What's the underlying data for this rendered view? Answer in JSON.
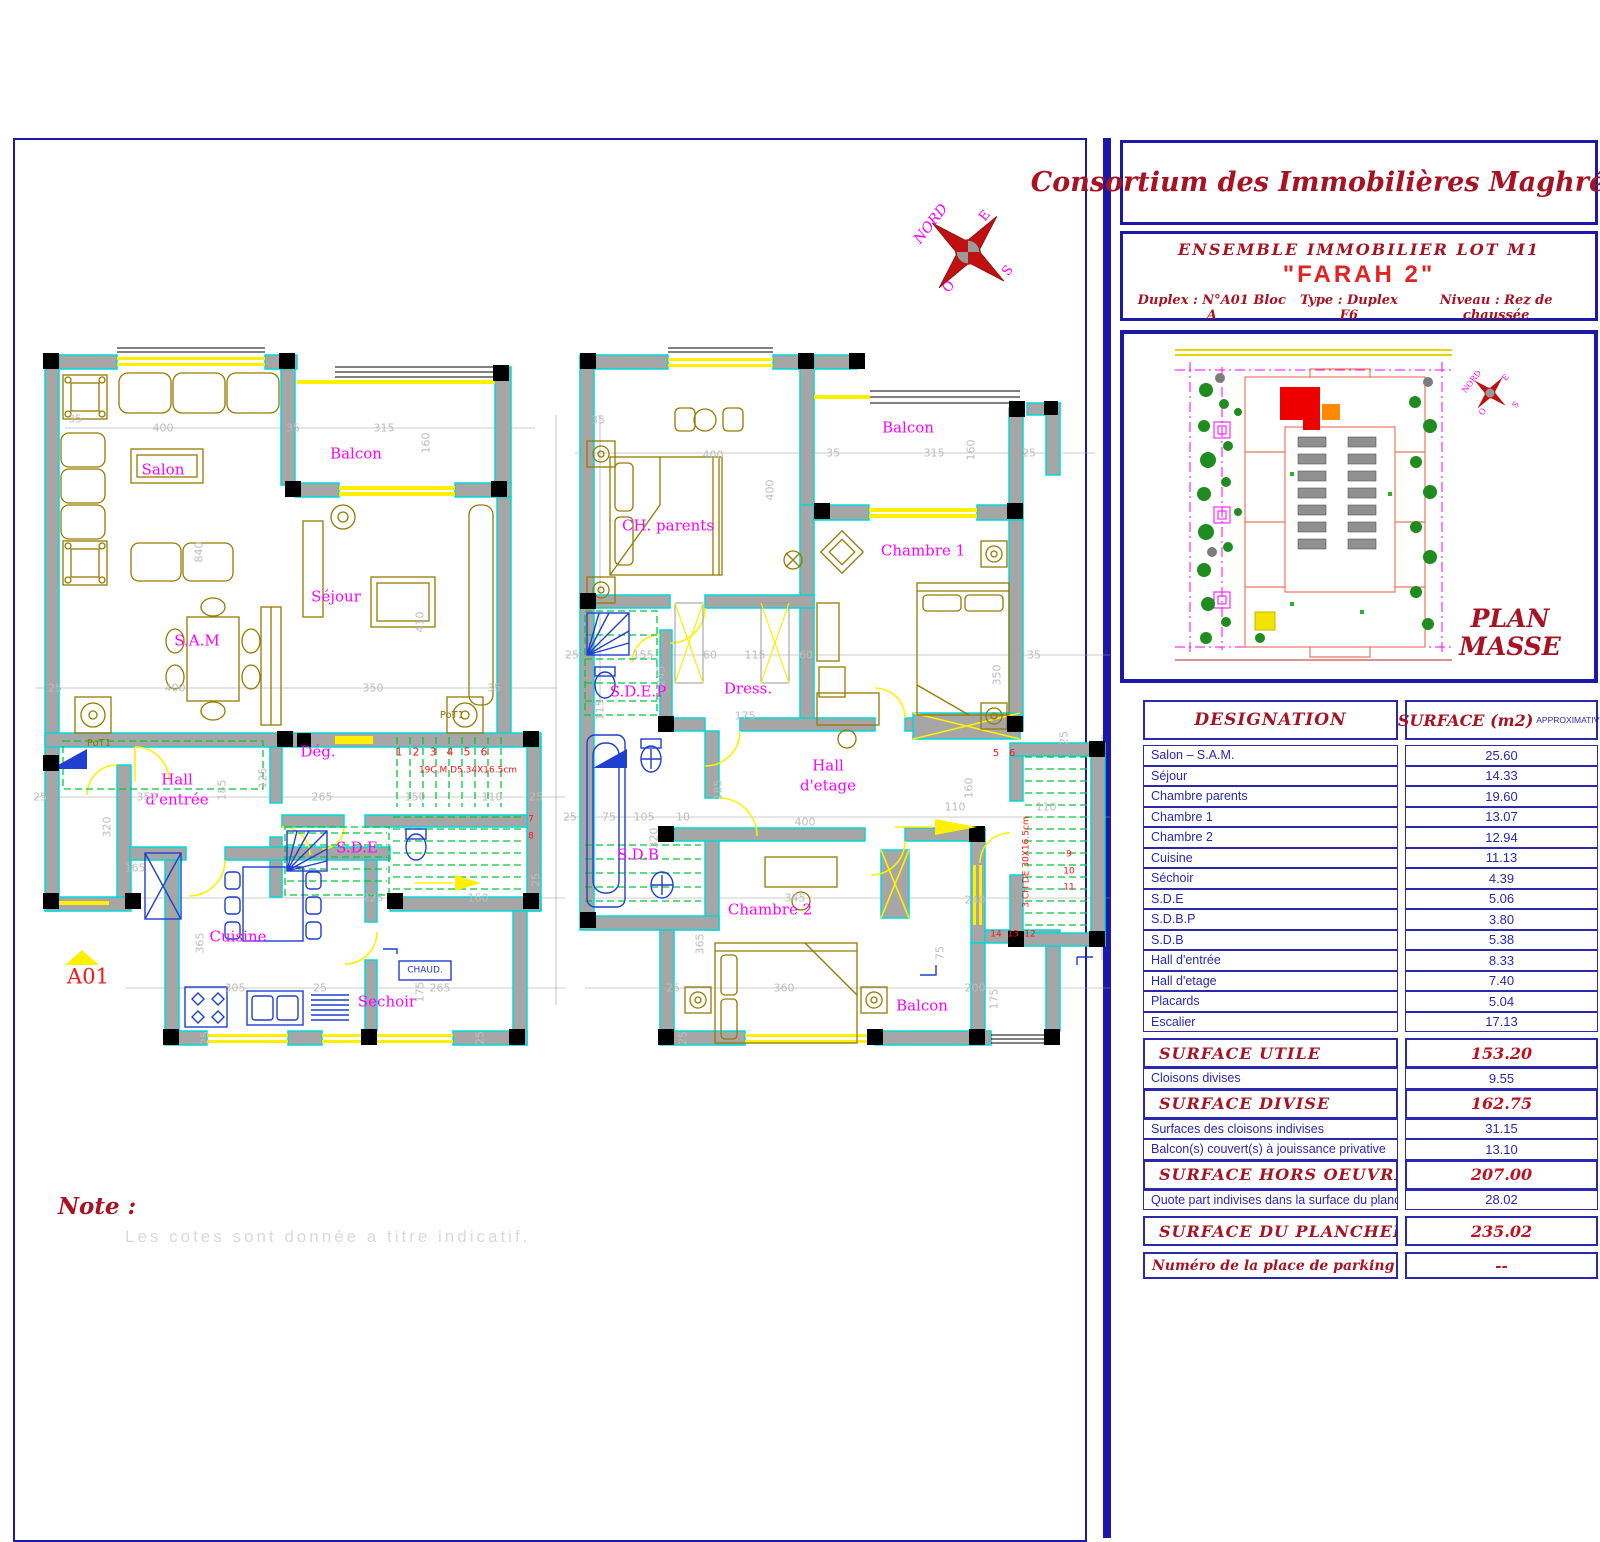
{
  "palette": {
    "mag": "#FF00FF",
    "red": "#FF1414",
    "dim": "#BDBDBD",
    "olive": "#8F7600",
    "blue": "#2233CC",
    "drk": "#A81324",
    "ltg": "#D9D9D9"
  },
  "title_block": {
    "company": "Consortium des Immobilières Maghrébines",
    "project": "ENSEMBLE   IMMOBILIER   LOT   M1",
    "name": "\"FARAH 2\"",
    "duplex": "Duplex : N°A01  Bloc A",
    "type": "Type : Duplex F6",
    "niveau": "Niveau : Rez de chaussée"
  },
  "plan_masse": {
    "caption1": "PLAN",
    "caption2": "MASSE"
  },
  "compass": {
    "north": "NORD",
    "east": "E",
    "west": "O",
    "south": "S"
  },
  "note": {
    "heading": "Note :",
    "text": "Les cotes sont donnée a titre indicatif."
  },
  "surface_table": {
    "header": {
      "designation": "DESIGNATION",
      "surface": "SURFACE  (m2)",
      "approx": "APPROXIMATIVE"
    },
    "rows": [
      {
        "label": "Salon – S.A.M.",
        "value": "25.60",
        "style": "item"
      },
      {
        "label": "Séjour",
        "value": "14.33",
        "style": "item"
      },
      {
        "label": "Chambre  parents",
        "value": "19.60",
        "style": "item"
      },
      {
        "label": "Chambre  1",
        "value": "13.07",
        "style": "item"
      },
      {
        "label": "Chambre  2",
        "value": "12.94",
        "style": "item"
      },
      {
        "label": "Cuisine",
        "value": "11.13",
        "style": "item"
      },
      {
        "label": "Séchoir",
        "value": "4.39",
        "style": "item"
      },
      {
        "label": "S.D.E",
        "value": "5.06",
        "style": "item"
      },
      {
        "label": "S.D.B.P",
        "value": "3.80",
        "style": "item"
      },
      {
        "label": "S.D.B",
        "value": "5.38",
        "style": "item"
      },
      {
        "label": "Hall  d'entrée",
        "value": "8.33",
        "style": "item"
      },
      {
        "label": "Hall  d'etage",
        "value": "7.40",
        "style": "item"
      },
      {
        "label": "Placards",
        "value": "5.04",
        "style": "item"
      },
      {
        "label": "Escalier",
        "value": "17.13",
        "style": "item"
      },
      {
        "label": "SURFACE  UTILE",
        "value": "153.20",
        "style": "total",
        "gap": true
      },
      {
        "label": "Cloisons  divises",
        "value": "9.55",
        "style": "item"
      },
      {
        "label": "SURFACE  DIVISE",
        "value": "162.75",
        "style": "total"
      },
      {
        "label": "Surfaces  des  cloisons  indivises",
        "value": "31.15",
        "style": "item"
      },
      {
        "label": "Balcon(s)  couvert(s)  à  jouissance  privative",
        "value": "13.10",
        "style": "item"
      },
      {
        "label": "SURFACE  HORS  OEUVRE",
        "value": "207.00",
        "style": "total"
      },
      {
        "label": "Quote  part  indivises  dans  la  surface  du  plancher",
        "value": "28.02",
        "style": "item"
      },
      {
        "label": "SURFACE  DU  PLANCHER",
        "value": "235.02",
        "style": "total",
        "gap": true
      },
      {
        "label": "Numéro  de  la  place  de  parking",
        "value": "--",
        "style": "footer",
        "gap": true
      }
    ]
  },
  "plan_labels": [
    {
      "t": "Salon",
      "x": 163,
      "y": 470,
      "s": 15,
      "c": "mag"
    },
    {
      "t": "Balcon",
      "x": 356,
      "y": 454,
      "s": 15,
      "c": "mag"
    },
    {
      "t": "Séjour",
      "x": 336,
      "y": 597,
      "s": 15,
      "c": "mag"
    },
    {
      "t": "S.A.M",
      "x": 197,
      "y": 641,
      "s": 15,
      "c": "mag"
    },
    {
      "t": "Dég.",
      "x": 318,
      "y": 752,
      "s": 15,
      "c": "mag"
    },
    {
      "t": "Hall",
      "x": 177,
      "y": 780,
      "s": 15,
      "c": "mag"
    },
    {
      "t": "d'entrée",
      "x": 177,
      "y": 800,
      "s": 15,
      "c": "mag"
    },
    {
      "t": "S.D.E",
      "x": 357,
      "y": 848,
      "s": 15,
      "c": "mag"
    },
    {
      "t": "Cuisine",
      "x": 238,
      "y": 937,
      "s": 15,
      "c": "mag"
    },
    {
      "t": "Sechoir",
      "x": 387,
      "y": 1002,
      "s": 15,
      "c": "mag"
    },
    {
      "t": "A01",
      "x": 88,
      "y": 977,
      "s": 21,
      "c": "red",
      "f": "serif"
    },
    {
      "t": "PoT1",
      "x": 99,
      "y": 744,
      "s": 10,
      "c": "olive"
    },
    {
      "t": "PoT1",
      "x": 452,
      "y": 716,
      "s": 10,
      "c": "olive"
    },
    {
      "t": "1",
      "x": 399,
      "y": 752,
      "s": 11,
      "c": "red"
    },
    {
      "t": "2",
      "x": 416,
      "y": 752,
      "s": 11,
      "c": "red"
    },
    {
      "t": "3",
      "x": 433,
      "y": 752,
      "s": 11,
      "c": "red"
    },
    {
      "t": "4",
      "x": 450,
      "y": 752,
      "s": 11,
      "c": "red"
    },
    {
      "t": "5",
      "x": 467,
      "y": 752,
      "s": 11,
      "c": "red"
    },
    {
      "t": "6",
      "x": 484,
      "y": 752,
      "s": 11,
      "c": "red"
    },
    {
      "t": "19C.M D5.34X16.5cm",
      "x": 468,
      "y": 771,
      "s": 9,
      "c": "red"
    },
    {
      "t": "7",
      "x": 531,
      "y": 820,
      "s": 9,
      "c": "red"
    },
    {
      "t": "8",
      "x": 531,
      "y": 837,
      "s": 9,
      "c": "red"
    },
    {
      "t": "CHAUD.",
      "x": 425,
      "y": 971,
      "s": 9,
      "c": "blue"
    },
    {
      "t": "35",
      "x": 75,
      "y": 419,
      "s": 11,
      "c": "dim"
    },
    {
      "t": "400",
      "x": 163,
      "y": 428,
      "s": 11,
      "c": "dim"
    },
    {
      "t": "35",
      "x": 293,
      "y": 428,
      "s": 11,
      "c": "dim"
    },
    {
      "t": "315",
      "x": 384,
      "y": 428,
      "s": 11,
      "c": "dim"
    },
    {
      "t": "160",
      "x": 426,
      "y": 443,
      "s": 11,
      "c": "dim",
      "r": -90
    },
    {
      "t": "840",
      "x": 199,
      "y": 552,
      "s": 11,
      "c": "dim",
      "r": -90
    },
    {
      "t": "410",
      "x": 420,
      "y": 622,
      "s": 11,
      "c": "dim",
      "r": -90
    },
    {
      "t": "25",
      "x": 55,
      "y": 688,
      "s": 11,
      "c": "dim"
    },
    {
      "t": "400",
      "x": 175,
      "y": 688,
      "s": 11,
      "c": "dim"
    },
    {
      "t": "350",
      "x": 373,
      "y": 688,
      "s": 11,
      "c": "dim"
    },
    {
      "t": "35",
      "x": 494,
      "y": 688,
      "s": 11,
      "c": "dim"
    },
    {
      "t": "25",
      "x": 40,
      "y": 797,
      "s": 11,
      "c": "dim"
    },
    {
      "t": "350",
      "x": 147,
      "y": 797,
      "s": 11,
      "c": "dim"
    },
    {
      "t": "185",
      "x": 222,
      "y": 790,
      "s": 11,
      "c": "dim",
      "r": -90
    },
    {
      "t": "265",
      "x": 322,
      "y": 797,
      "s": 11,
      "c": "dim"
    },
    {
      "t": "125",
      "x": 263,
      "y": 778,
      "s": 11,
      "c": "dim",
      "r": -90
    },
    {
      "t": "150",
      "x": 415,
      "y": 797,
      "s": 11,
      "c": "dim"
    },
    {
      "t": "110",
      "x": 492,
      "y": 797,
      "s": 11,
      "c": "dim"
    },
    {
      "t": "25",
      "x": 536,
      "y": 797,
      "s": 11,
      "c": "dim"
    },
    {
      "t": "320",
      "x": 107,
      "y": 827,
      "s": 11,
      "c": "dim",
      "r": -90
    },
    {
      "t": "165",
      "x": 135,
      "y": 868,
      "s": 11,
      "c": "dim"
    },
    {
      "t": "225",
      "x": 373,
      "y": 898,
      "s": 11,
      "c": "dim"
    },
    {
      "t": "160",
      "x": 478,
      "y": 898,
      "s": 11,
      "c": "dim"
    },
    {
      "t": "25",
      "x": 536,
      "y": 880,
      "s": 11,
      "c": "dim",
      "r": -90
    },
    {
      "t": "365",
      "x": 200,
      "y": 943,
      "s": 11,
      "c": "dim",
      "r": -90
    },
    {
      "t": "305",
      "x": 235,
      "y": 988,
      "s": 11,
      "c": "dim"
    },
    {
      "t": "25",
      "x": 320,
      "y": 988,
      "s": 11,
      "c": "dim"
    },
    {
      "t": "265",
      "x": 440,
      "y": 988,
      "s": 11,
      "c": "dim"
    },
    {
      "t": "175",
      "x": 420,
      "y": 992,
      "s": 11,
      "c": "dim",
      "r": -90
    },
    {
      "t": "25",
      "x": 205,
      "y": 1038,
      "s": 11,
      "c": "dim",
      "r": -90
    },
    {
      "t": "25",
      "x": 480,
      "y": 1038,
      "s": 11,
      "c": "dim",
      "r": -90
    },
    {
      "t": "CH. parents",
      "x": 668,
      "y": 526,
      "s": 15,
      "c": "mag"
    },
    {
      "t": "Balcon",
      "x": 908,
      "y": 428,
      "s": 15,
      "c": "mag"
    },
    {
      "t": "Chambre 1",
      "x": 923,
      "y": 551,
      "s": 15,
      "c": "mag"
    },
    {
      "t": "S.D.E.P",
      "x": 638,
      "y": 692,
      "s": 15,
      "c": "mag"
    },
    {
      "t": "Dress.",
      "x": 748,
      "y": 689,
      "s": 15,
      "c": "mag"
    },
    {
      "t": "Hall",
      "x": 828,
      "y": 766,
      "s": 15,
      "c": "mag"
    },
    {
      "t": "d'etage",
      "x": 828,
      "y": 786,
      "s": 15,
      "c": "mag"
    },
    {
      "t": "S.D.B",
      "x": 638,
      "y": 855,
      "s": 15,
      "c": "mag"
    },
    {
      "t": "Chambre 2",
      "x": 770,
      "y": 910,
      "s": 15,
      "c": "mag"
    },
    {
      "t": "Balcon",
      "x": 922,
      "y": 1006,
      "s": 15,
      "c": "mag"
    },
    {
      "t": "5",
      "x": 996,
      "y": 754,
      "s": 10,
      "c": "red"
    },
    {
      "t": "6",
      "x": 1012,
      "y": 754,
      "s": 10,
      "c": "red"
    },
    {
      "t": "3 CH DE 30X16.5cm",
      "x": 1027,
      "y": 862,
      "s": 9,
      "c": "red",
      "r": -90
    },
    {
      "t": "9",
      "x": 1069,
      "y": 855,
      "s": 9,
      "c": "red"
    },
    {
      "t": "10",
      "x": 1069,
      "y": 872,
      "s": 9,
      "c": "red"
    },
    {
      "t": "11",
      "x": 1069,
      "y": 888,
      "s": 9,
      "c": "red"
    },
    {
      "t": "14",
      "x": 996,
      "y": 935,
      "s": 9,
      "c": "red"
    },
    {
      "t": "13",
      "x": 1013,
      "y": 935,
      "s": 9,
      "c": "red"
    },
    {
      "t": "12",
      "x": 1030,
      "y": 935,
      "s": 9,
      "c": "red"
    },
    {
      "t": "35",
      "x": 598,
      "y": 420,
      "s": 11,
      "c": "dim"
    },
    {
      "t": "400",
      "x": 713,
      "y": 455,
      "s": 11,
      "c": "dim"
    },
    {
      "t": "35",
      "x": 833,
      "y": 453,
      "s": 11,
      "c": "dim"
    },
    {
      "t": "315",
      "x": 934,
      "y": 453,
      "s": 11,
      "c": "dim"
    },
    {
      "t": "160",
      "x": 971,
      "y": 450,
      "s": 11,
      "c": "dim",
      "r": -90
    },
    {
      "t": "25",
      "x": 1029,
      "y": 453,
      "s": 11,
      "c": "dim"
    },
    {
      "t": "400",
      "x": 770,
      "y": 490,
      "s": 11,
      "c": "dim",
      "r": -90
    },
    {
      "t": "350",
      "x": 997,
      "y": 675,
      "s": 11,
      "c": "dim",
      "r": -90
    },
    {
      "t": "25",
      "x": 572,
      "y": 655,
      "s": 11,
      "c": "dim"
    },
    {
      "t": "155",
      "x": 643,
      "y": 655,
      "s": 11,
      "c": "dim"
    },
    {
      "t": "245",
      "x": 661,
      "y": 676,
      "s": 11,
      "c": "dim",
      "r": -90
    },
    {
      "t": "60",
      "x": 710,
      "y": 655,
      "s": 11,
      "c": "dim"
    },
    {
      "t": "115",
      "x": 755,
      "y": 655,
      "s": 11,
      "c": "dim"
    },
    {
      "t": "60",
      "x": 806,
      "y": 655,
      "s": 11,
      "c": "dim"
    },
    {
      "t": "35",
      "x": 1034,
      "y": 655,
      "s": 11,
      "c": "dim"
    },
    {
      "t": "115",
      "x": 600,
      "y": 710,
      "s": 11,
      "c": "dim",
      "r": -90
    },
    {
      "t": "175",
      "x": 745,
      "y": 716,
      "s": 11,
      "c": "dim"
    },
    {
      "t": "185",
      "x": 718,
      "y": 790,
      "s": 11,
      "c": "dim",
      "r": -90
    },
    {
      "t": "25",
      "x": 570,
      "y": 817,
      "s": 11,
      "c": "dim"
    },
    {
      "t": "75",
      "x": 609,
      "y": 817,
      "s": 11,
      "c": "dim"
    },
    {
      "t": "105",
      "x": 644,
      "y": 817,
      "s": 11,
      "c": "dim"
    },
    {
      "t": "10",
      "x": 683,
      "y": 817,
      "s": 11,
      "c": "dim"
    },
    {
      "t": "400",
      "x": 805,
      "y": 822,
      "s": 11,
      "c": "dim"
    },
    {
      "t": "320",
      "x": 654,
      "y": 838,
      "s": 11,
      "c": "dim",
      "r": -90
    },
    {
      "t": "110",
      "x": 955,
      "y": 807,
      "s": 11,
      "c": "dim"
    },
    {
      "t": "160",
      "x": 969,
      "y": 788,
      "s": 11,
      "c": "dim",
      "r": -90
    },
    {
      "t": "110",
      "x": 1046,
      "y": 807,
      "s": 11,
      "c": "dim"
    },
    {
      "t": "25",
      "x": 1064,
      "y": 738,
      "s": 11,
      "c": "dim",
      "r": -90
    },
    {
      "t": "345",
      "x": 795,
      "y": 898,
      "s": 11,
      "c": "dim"
    },
    {
      "t": "240",
      "x": 975,
      "y": 900,
      "s": 11,
      "c": "dim"
    },
    {
      "t": "365",
      "x": 700,
      "y": 944,
      "s": 11,
      "c": "dim",
      "r": -90
    },
    {
      "t": "360",
      "x": 784,
      "y": 988,
      "s": 11,
      "c": "dim"
    },
    {
      "t": "25",
      "x": 673,
      "y": 988,
      "s": 11,
      "c": "dim"
    },
    {
      "t": "200",
      "x": 975,
      "y": 988,
      "s": 11,
      "c": "dim"
    },
    {
      "t": "175",
      "x": 994,
      "y": 999,
      "s": 11,
      "c": "dim",
      "r": -90
    },
    {
      "t": "25",
      "x": 683,
      "y": 1038,
      "s": 11,
      "c": "dim",
      "r": -90
    },
    {
      "t": "75",
      "x": 940,
      "y": 953,
      "s": 11,
      "c": "dim",
      "r": -90
    },
    {
      "t": "NORD",
      "x": 931,
      "y": 224,
      "s": 14,
      "c": "mag",
      "r": -52,
      "f": "serif",
      "i": true
    },
    {
      "t": "E",
      "x": 985,
      "y": 216,
      "s": 13,
      "c": "mag",
      "r": -52
    },
    {
      "t": "O",
      "x": 949,
      "y": 287,
      "s": 13,
      "c": "mag",
      "r": -52
    },
    {
      "t": "S",
      "x": 1008,
      "y": 271,
      "s": 13,
      "c": "mag",
      "r": -52
    },
    {
      "t": "NORD",
      "x": 1472,
      "y": 382,
      "s": 8,
      "c": "mag",
      "r": -52
    },
    {
      "t": "E",
      "x": 1506,
      "y": 378,
      "s": 8,
      "c": "mag",
      "r": -52
    },
    {
      "t": "O",
      "x": 1483,
      "y": 412,
      "s": 8,
      "c": "mag",
      "r": -52
    },
    {
      "t": "S",
      "x": 1516,
      "y": 405,
      "s": 8,
      "c": "mag",
      "r": -52
    }
  ]
}
